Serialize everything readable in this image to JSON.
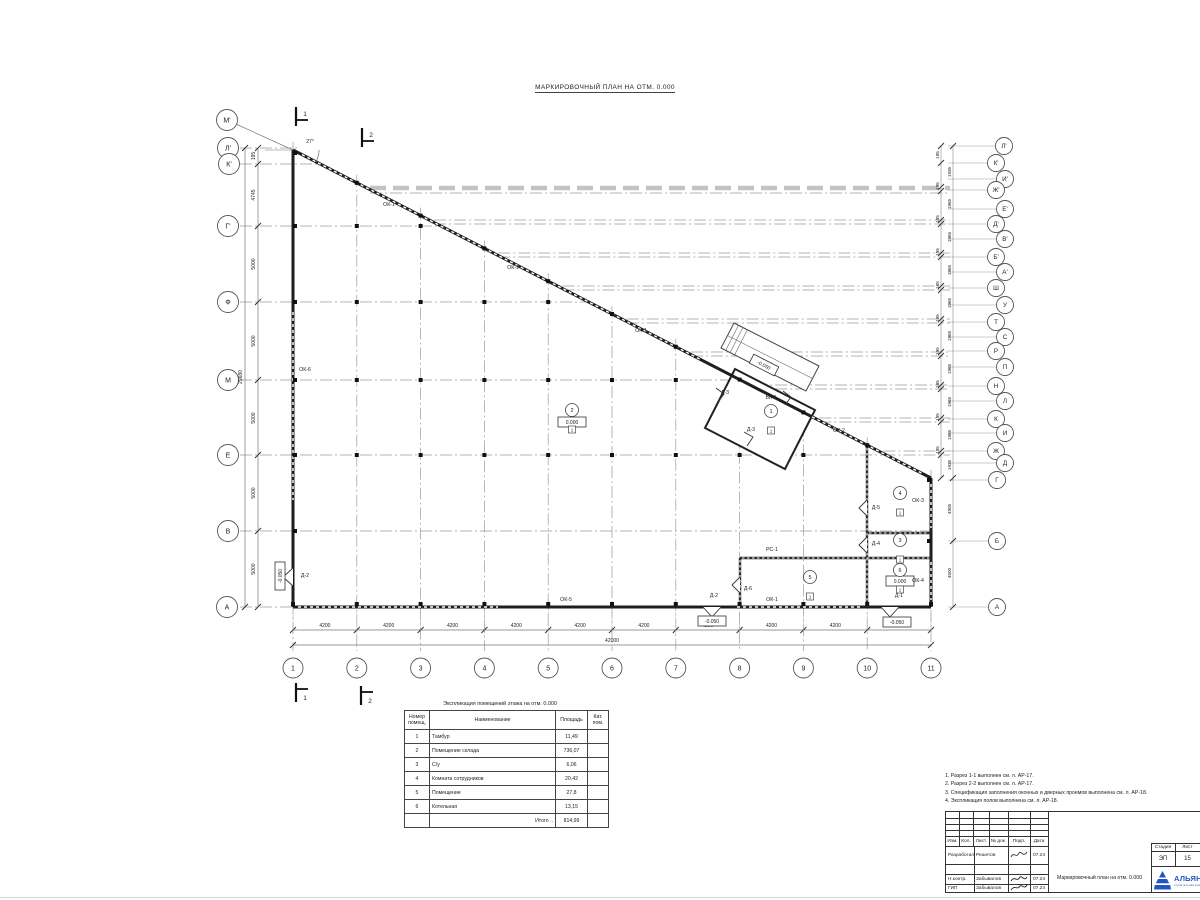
{
  "page": {
    "title": "МАРКИРОВОЧНЫЙ ПЛАН НА ОТМ. 0.000"
  },
  "plan": {
    "angle_label": "27°",
    "axes_left": [
      {
        "label": "М'",
        "bx": 227,
        "by": 120,
        "leader": true
      },
      {
        "label": "Л'",
        "bx": 228,
        "by": 148,
        "y": 148,
        "x2": 300
      },
      {
        "label": "К'",
        "bx": 229,
        "by": 164,
        "y": 164,
        "x2": 322
      },
      {
        "label": "Г'",
        "bx": 228,
        "by": 226,
        "y": 226,
        "x2": 441
      },
      {
        "label": "Ф",
        "bx": 228,
        "by": 302,
        "y": 302,
        "x2": 589
      },
      {
        "label": "М",
        "bx": 228,
        "by": 380,
        "y": 380,
        "x2": 742
      },
      {
        "label": "Е",
        "bx": 228,
        "by": 455,
        "y": 455,
        "x2": 888
      },
      {
        "label": "В",
        "bx": 228,
        "by": 531,
        "y": 531,
        "x2": 931
      },
      {
        "label": "А",
        "bx": 227,
        "by": 607,
        "y": 607,
        "x2": 320
      }
    ],
    "axes_right": [
      {
        "label": "Л'",
        "bx": 1004,
        "by": 146
      },
      {
        "label": "К'",
        "bx": 996,
        "by": 163
      },
      {
        "label": "И'",
        "bx": 1005,
        "by": 179
      },
      {
        "label": "Ж'",
        "bx": 996,
        "by": 190
      },
      {
        "label": "Е'",
        "bx": 1005,
        "by": 209
      },
      {
        "label": "Д'",
        "bx": 996,
        "by": 224
      },
      {
        "label": "В'",
        "bx": 1005,
        "by": 239
      },
      {
        "label": "Б'",
        "bx": 996,
        "by": 257
      },
      {
        "label": "А'",
        "bx": 1005,
        "by": 272
      },
      {
        "label": "Ш",
        "bx": 996,
        "by": 288
      },
      {
        "label": "У",
        "bx": 1005,
        "by": 305
      },
      {
        "label": "Т",
        "bx": 996,
        "by": 322
      },
      {
        "label": "С",
        "bx": 1005,
        "by": 337
      },
      {
        "label": "Р",
        "bx": 996,
        "by": 351
      },
      {
        "label": "П",
        "bx": 1005,
        "by": 367
      },
      {
        "label": "Н",
        "bx": 996,
        "by": 386
      },
      {
        "label": "Л",
        "bx": 1005,
        "by": 401
      },
      {
        "label": "К",
        "bx": 996,
        "by": 419
      },
      {
        "label": "И",
        "bx": 1005,
        "by": 433
      },
      {
        "label": "Ж",
        "bx": 996,
        "by": 451
      },
      {
        "label": "Д",
        "bx": 1005,
        "by": 463
      },
      {
        "label": "Г",
        "bx": 997,
        "by": 480
      },
      {
        "label": "Б",
        "bx": 997,
        "by": 541
      },
      {
        "label": "А",
        "bx": 997,
        "by": 607
      }
    ],
    "axes_bottom": [
      "1",
      "2",
      "3",
      "4",
      "5",
      "6",
      "7",
      "8",
      "9",
      "10",
      "11"
    ],
    "dims_left": [
      {
        "t": "195",
        "y": 156
      },
      {
        "t": "4745",
        "y": 195
      },
      {
        "t": "5000",
        "y": 264
      },
      {
        "t": "5000",
        "y": 341
      },
      {
        "t": "5000",
        "y": 418
      },
      {
        "t": "5000",
        "y": 493
      },
      {
        "t": "5000",
        "y": 569
      }
    ],
    "dim_left_total": "29680",
    "dims_right": [
      {
        "t": "195",
        "x": 939,
        "y": 155
      },
      {
        "t": "1935",
        "x": 951,
        "y": 172
      },
      {
        "t": "195",
        "x": 939,
        "y": 186
      },
      {
        "t": "1965",
        "x": 951,
        "y": 204
      },
      {
        "t": "195",
        "x": 939,
        "y": 219
      },
      {
        "t": "1965",
        "x": 951,
        "y": 237
      },
      {
        "t": "195",
        "x": 939,
        "y": 252
      },
      {
        "t": "1965",
        "x": 951,
        "y": 270
      },
      {
        "t": "195",
        "x": 939,
        "y": 285
      },
      {
        "t": "1965",
        "x": 951,
        "y": 303
      },
      {
        "t": "195",
        "x": 939,
        "y": 318
      },
      {
        "t": "1965",
        "x": 951,
        "y": 336
      },
      {
        "t": "195",
        "x": 939,
        "y": 351
      },
      {
        "t": "1965",
        "x": 951,
        "y": 369
      },
      {
        "t": "195",
        "x": 939,
        "y": 384
      },
      {
        "t": "1965",
        "x": 951,
        "y": 402
      },
      {
        "t": "195",
        "x": 939,
        "y": 417
      },
      {
        "t": "1965",
        "x": 951,
        "y": 435
      },
      {
        "t": "195",
        "x": 939,
        "y": 450
      },
      {
        "t": "1935",
        "x": 951,
        "y": 465
      },
      {
        "t": "4905",
        "x": 951,
        "y": 509
      },
      {
        "t": "4500",
        "x": 951,
        "y": 573
      }
    ],
    "dim_bottom_segment": "4200",
    "dim_bottom_total": "42000",
    "labels": [
      {
        "t": "ОК-1",
        "x": 389,
        "y": 206
      },
      {
        "t": "ОК-1",
        "x": 513,
        "y": 269
      },
      {
        "t": "ОК-1",
        "x": 641,
        "y": 332
      },
      {
        "t": "ОК-2",
        "x": 839,
        "y": 432
      },
      {
        "t": "ОК-3",
        "x": 918,
        "y": 502
      },
      {
        "t": "ОК-4",
        "x": 918,
        "y": 582
      },
      {
        "t": "ОК-5",
        "x": 566,
        "y": 601
      },
      {
        "t": "ОК-1",
        "x": 772,
        "y": 601
      },
      {
        "t": "ОК-6",
        "x": 305,
        "y": 371
      },
      {
        "t": "Д-2",
        "x": 305,
        "y": 577
      },
      {
        "t": "Д-2",
        "x": 714,
        "y": 597
      },
      {
        "t": "Д-1",
        "x": 899,
        "y": 597
      },
      {
        "t": "Д-6",
        "x": 748,
        "y": 590
      },
      {
        "t": "Д-5",
        "x": 876,
        "y": 509
      },
      {
        "t": "Д-4",
        "x": 876,
        "y": 545
      },
      {
        "t": "РС-1",
        "x": 772,
        "y": 551
      },
      {
        "t": "Д-3",
        "x": 725,
        "y": 394
      },
      {
        "t": "Д-3",
        "x": 751,
        "y": 431
      },
      {
        "t": "Вн-1",
        "x": 771,
        "y": 399
      }
    ],
    "levels": [
      {
        "t": "-0.050",
        "x": 280,
        "y": 576,
        "rot": -90
      },
      {
        "t": "-0.050",
        "x": 712,
        "y": 621,
        "rot": 0
      },
      {
        "t": "-0.050",
        "x": 897,
        "y": 622,
        "rot": 0
      },
      {
        "t": "-0.050",
        "x": 764,
        "y": 365,
        "rot": 27
      },
      {
        "t": "0.000",
        "x": 572,
        "y": 422,
        "rot": 0
      },
      {
        "t": "0.000",
        "x": 900,
        "y": 581,
        "rot": 0
      }
    ],
    "rooms": [
      {
        "n": "1",
        "x": 771,
        "y": 411,
        "f": "1"
      },
      {
        "n": "2",
        "x": 572,
        "y": 410,
        "f": "1"
      },
      {
        "n": "3",
        "x": 900,
        "y": 540,
        "f": "1"
      },
      {
        "n": "4",
        "x": 900,
        "y": 493,
        "f": "1"
      },
      {
        "n": "5",
        "x": 810,
        "y": 577,
        "f": "1"
      },
      {
        "n": "6",
        "x": 900,
        "y": 570,
        "f": "1"
      }
    ],
    "sections": [
      {
        "n": "1",
        "x": 296,
        "y": 107,
        "pos": "top"
      },
      {
        "n": "2",
        "x": 362,
        "y": 128,
        "pos": "top"
      },
      {
        "n": "1",
        "x": 296,
        "y": 683,
        "pos": "bottom"
      },
      {
        "n": "2",
        "x": 361,
        "y": 686,
        "pos": "bottom"
      }
    ]
  },
  "schedule": {
    "title": "Экспликация помещений этажа на отм. 0.000",
    "headers": [
      "Номер помещ.",
      "Наименование",
      "Площадь",
      "Кат. пом."
    ],
    "rows": [
      [
        "1",
        "Тамбур",
        "11,49",
        ""
      ],
      [
        "2",
        "Помещение склада",
        "736,07",
        ""
      ],
      [
        "3",
        "С/у",
        "6,06",
        ""
      ],
      [
        "4",
        "Комната сотрудников",
        "20,42",
        ""
      ],
      [
        "5",
        "Помещение",
        "27,8",
        ""
      ],
      [
        "6",
        "Котельная",
        "13,15",
        ""
      ]
    ],
    "total_label": "Итого ..",
    "total": "814,99"
  },
  "notes": [
    "1. Разрез 1-1 выполнен см. л. АР-17.",
    "2. Разрез 2-2 выполнен см. л. АР-17.",
    "3. Спецификация заполнения оконных и дверных проемов выполнена см. л. АР-18.",
    "4. Экспликация полов выполнена см. л. АР-18."
  ],
  "stamp": {
    "header_cols": [
      "Изм.",
      "Кол.",
      "Лист",
      "№ док.",
      "Подп.",
      "Дата"
    ],
    "rows": [
      {
        "role": "Разработал",
        "name": "Решетов",
        "date": "07.24"
      },
      {
        "role": "",
        "name": "",
        "date": ""
      },
      {
        "role": "Н.контр.",
        "name": "Забывалов",
        "date": "07.24"
      },
      {
        "role": "ГИП",
        "name": "Забывалов",
        "date": "07.24"
      }
    ],
    "doc_title": "Маркировочный план на отм. 0.000",
    "stage_label": "Стадия",
    "sheet_label": "Лист",
    "sheets_label": "Листов",
    "stage": "ЭП",
    "sheet": "15"
  },
  "logo": {
    "text": "АЛЬЯНС",
    "sub": "строительная компания",
    "color": "#2356c0"
  }
}
